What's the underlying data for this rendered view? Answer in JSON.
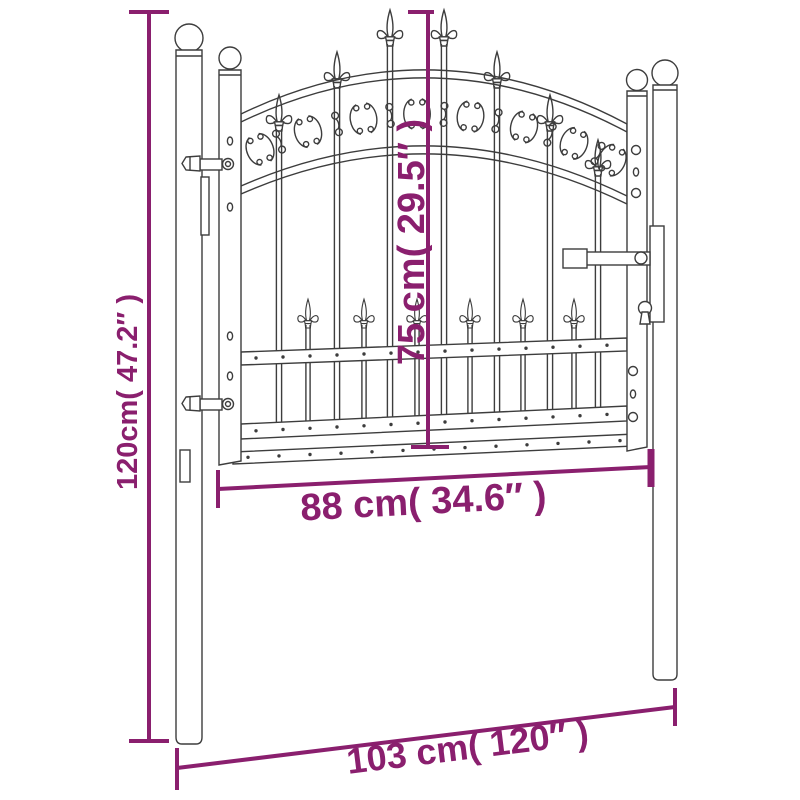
{
  "diagram": {
    "background_color": "#ffffff",
    "line_art_color": "#3d3d3d",
    "dimension_color": "#8a1f6e",
    "labels": {
      "total_height": "120cm( 47.2″ )",
      "gate_height": "75 cm( 29.5″ )",
      "gate_width": "88 cm( 34.6″ )",
      "total_width": "103 cm( 120″ )"
    }
  }
}
